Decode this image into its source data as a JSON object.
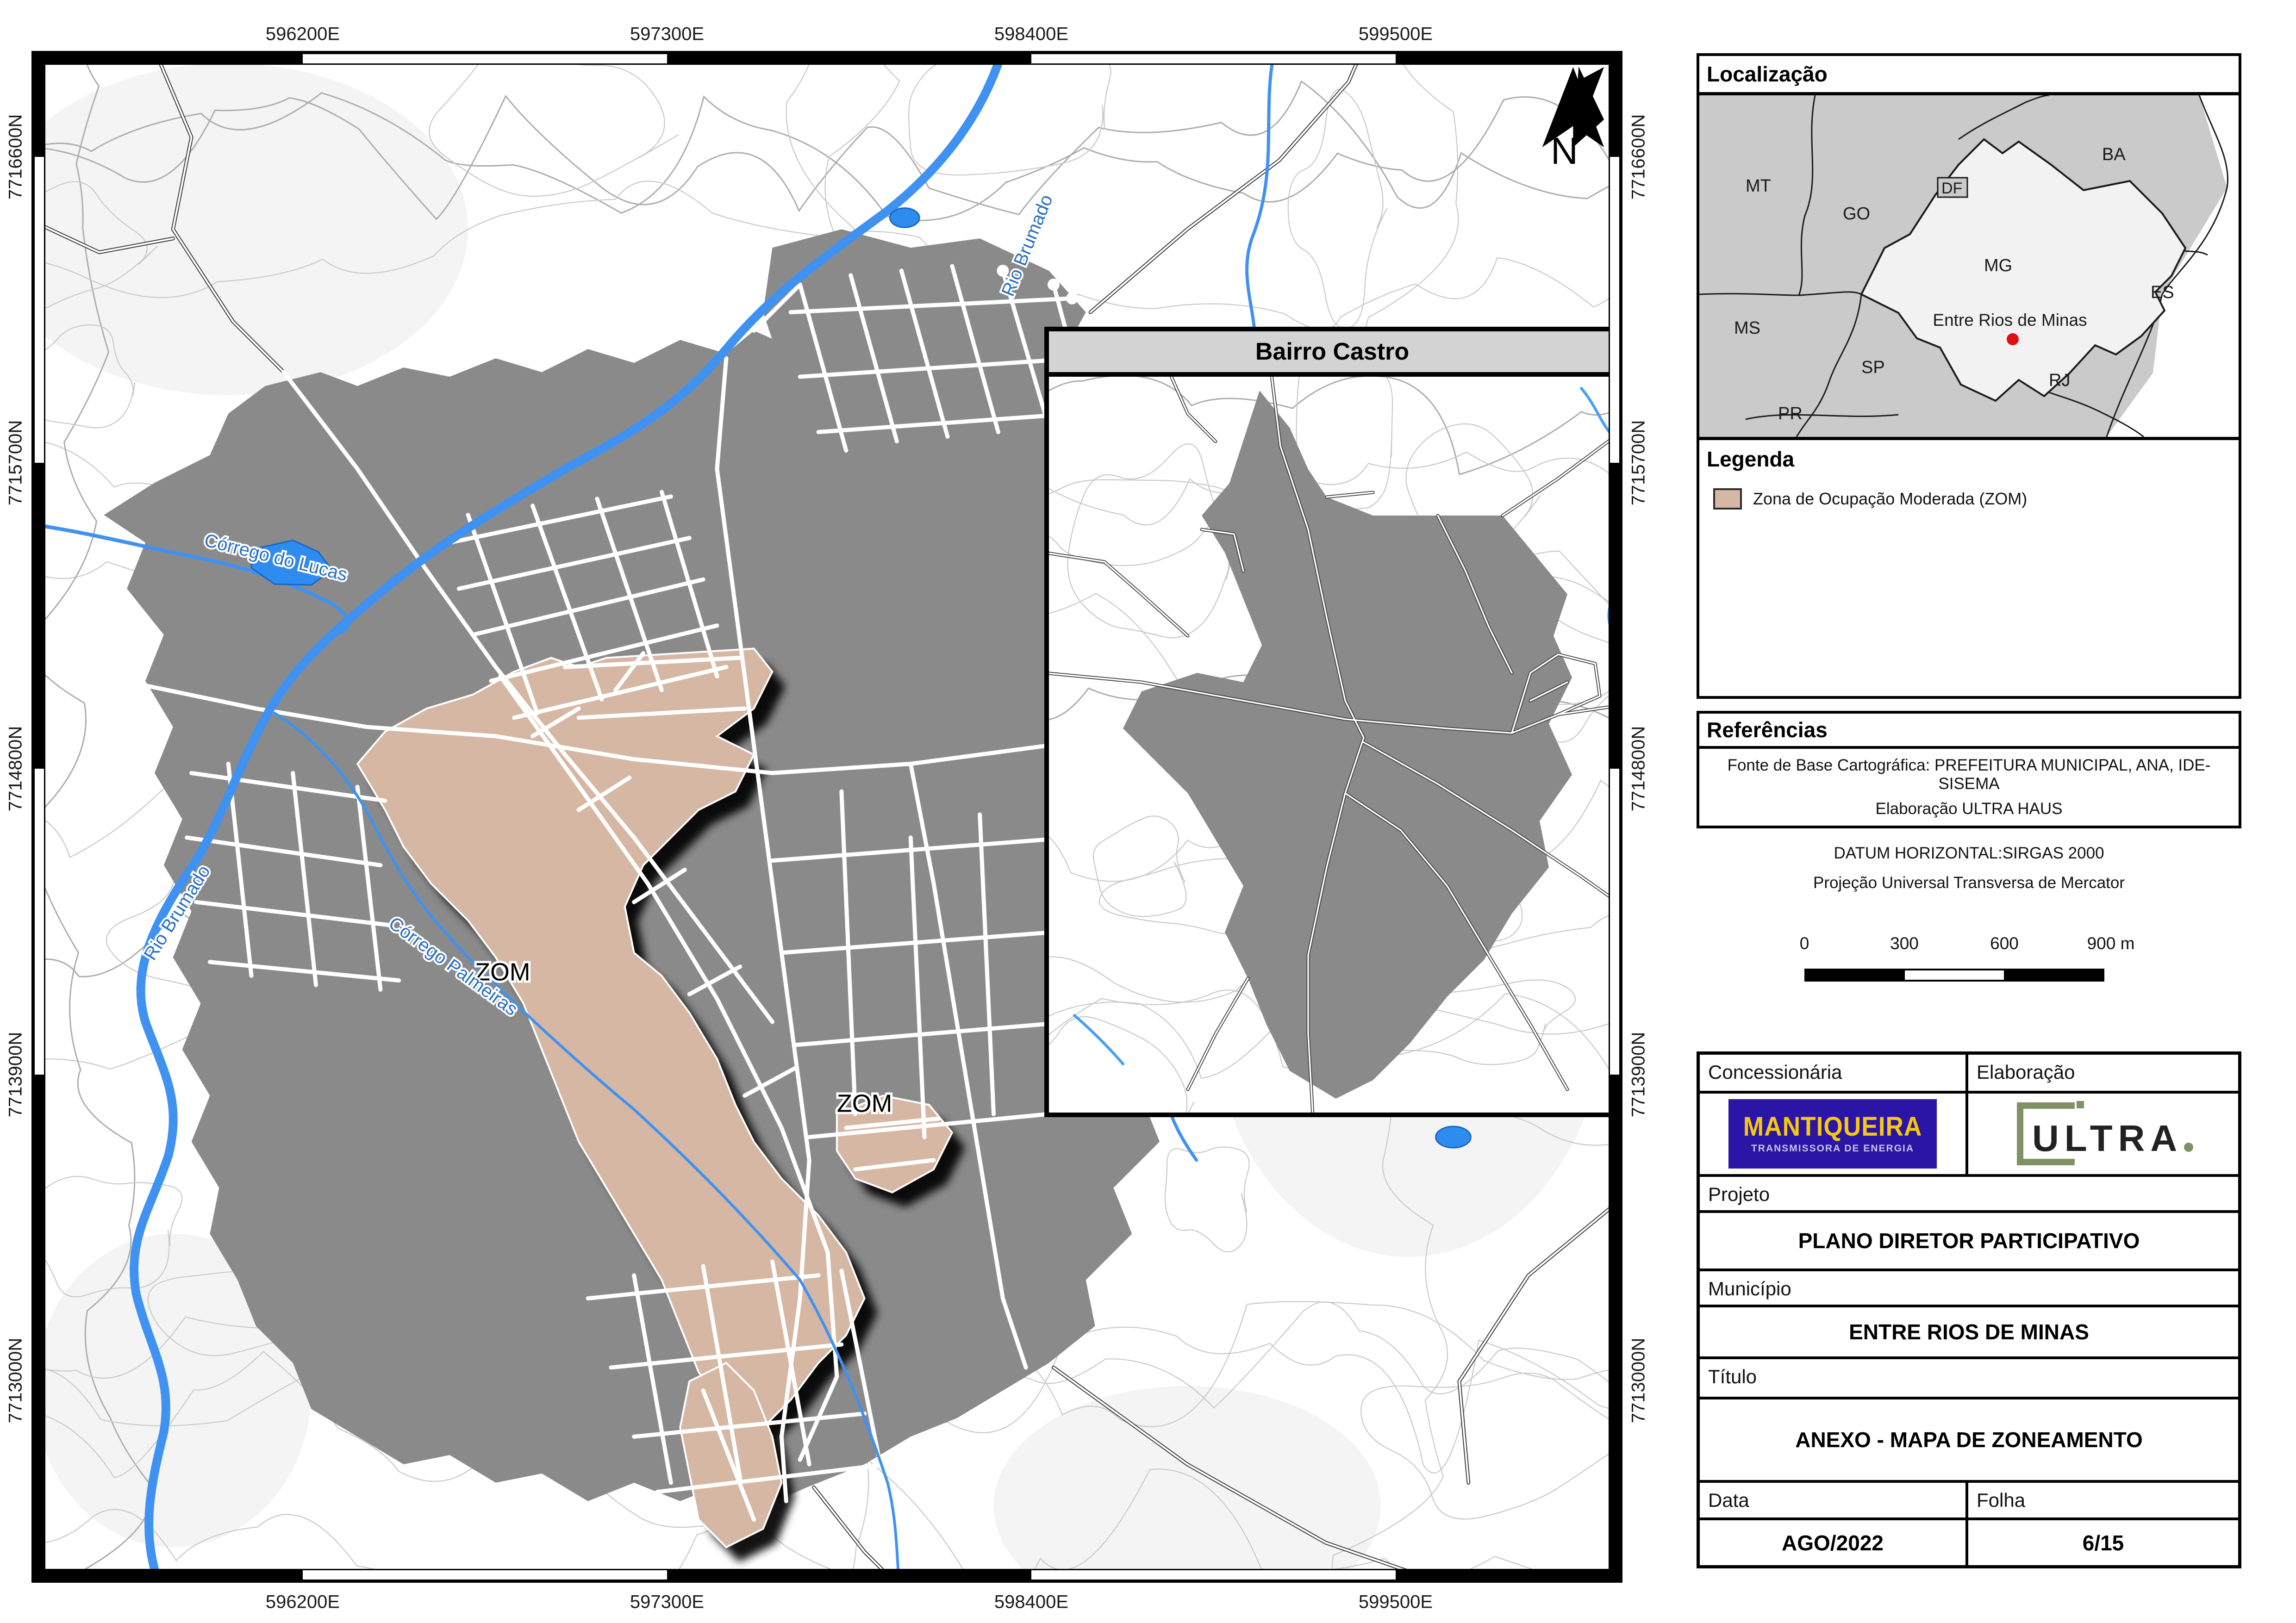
{
  "map": {
    "grid_e": [
      "596200E",
      "597300E",
      "598400E",
      "599500E"
    ],
    "grid_n": [
      "7716600N",
      "7715700N",
      "7714800N",
      "7713900N",
      "7713000N"
    ],
    "north_label": "N",
    "zom_label_1": "ZOM",
    "zom_label_2": "ZOM",
    "river_rio_brumado_top": "Rio Brumado",
    "river_rio_brumado_left": "Rio Brumado",
    "river_corrego_lucas": "Córrego do Lucas",
    "river_corrego_palmeiras": "Córrego Palmeiras"
  },
  "inset": {
    "title": "Bairro Castro"
  },
  "localizacao": {
    "title": "Localização",
    "states": [
      "MT",
      "GO",
      "DF",
      "BA",
      "MG",
      "ES",
      "MS",
      "SP",
      "PR",
      "RJ"
    ],
    "marker_label": "Entre Rios de Minas",
    "marker_color": "#e01010"
  },
  "legenda": {
    "title": "Legenda",
    "items": [
      {
        "label": "Zona de Ocupação Moderada (ZOM)",
        "color": "#d5b7a4"
      }
    ]
  },
  "referencias": {
    "title": "Referências",
    "line1": "Fonte de Base Cartográfica: PREFEITURA MUNICIPAL, ANA, IDE-SISEMA",
    "line2": "Elaboração ULTRA HAUS"
  },
  "datum": {
    "line1": "DATUM HORIZONTAL:SIRGAS 2000",
    "line2": "Projeção Universal Transversa de Mercator"
  },
  "scalebar": {
    "ticks": [
      "0",
      "300",
      "600",
      "900 m"
    ]
  },
  "titleblock": {
    "concessionaria_label": "Concessionária",
    "elaboracao_label": "Elaboração",
    "projeto_label": "Projeto",
    "projeto_value": "PLANO DIRETOR PARTICIPATIVO",
    "municipio_label": "Município",
    "municipio_value": "ENTRE RIOS DE MINAS",
    "titulo_label": "Título",
    "titulo_value": "ANEXO - MAPA DE ZONEAMENTO",
    "data_label": "Data",
    "data_value": "AGO/2022",
    "folha_label": "Folha",
    "folha_value": "6/15"
  },
  "logos": {
    "mantiqueira_line1": "MANTIQUEIRA",
    "mantiqueira_line2": "TRANSMISSORA DE ENERGIA",
    "ultra_text": "ULTRA",
    "ultra_dot": "."
  },
  "colors": {
    "zom_fill": "#d5b7a4",
    "urban_fill": "#8a8a8a",
    "water": "#3f92f1",
    "contour": "#c7c7c7",
    "state_map_bg": "#cacaca",
    "state_mg_fill": "#f2f2f2",
    "mantiqueira_bg": "#2a15a6",
    "mantiqueira_yellow": "#f7c80e",
    "ultra_green": "#7e9266"
  }
}
